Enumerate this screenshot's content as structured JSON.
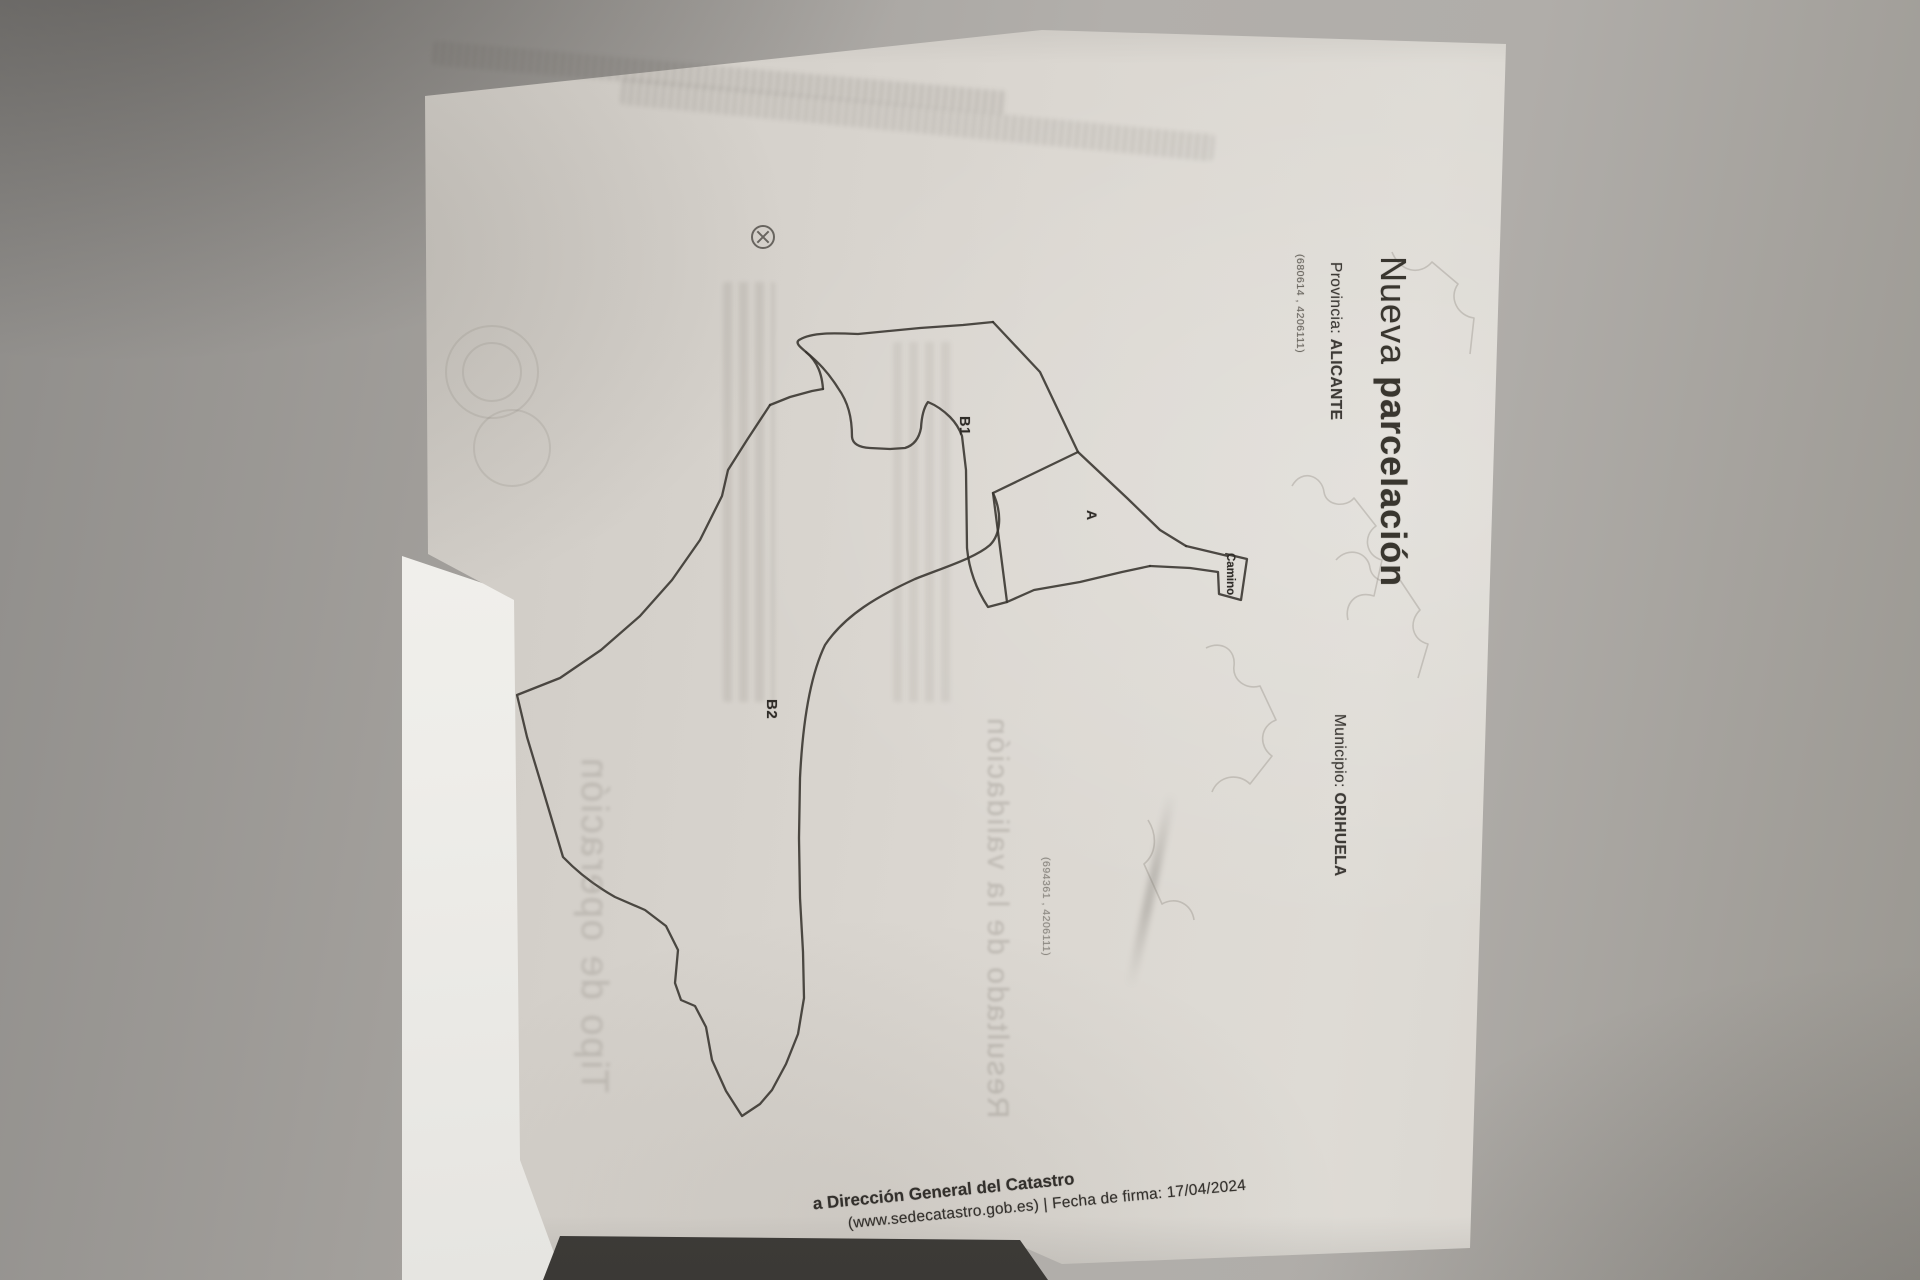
{
  "document": {
    "title": {
      "regular": "Nueva ",
      "bold": "parcelación"
    },
    "province": {
      "label": "Provincia: ",
      "value": "ALICANTE"
    },
    "municipality": {
      "label": "Municipio: ",
      "value": "ORIHUELA"
    },
    "coordinates": {
      "top_left": "(680614 , 4206111)",
      "bottom_right": "(694361 , 4206111)"
    },
    "footer": {
      "line1": "a Dirección General del Catastro",
      "line2": "(www.sedecatastro.gob.es)  |  Fecha de firma: 17/04/2024"
    }
  },
  "map": {
    "parcel_labels": {
      "b1": "B1",
      "b2": "B2",
      "a": "A",
      "road": "Camino"
    }
  },
  "ghost": {
    "right_heading": "Resultado de la validación",
    "left_heading": "Tipo de operación"
  },
  "colors": {
    "ink": "#37332e",
    "paper": "#d8d4ce",
    "background": "#a3a09c"
  }
}
